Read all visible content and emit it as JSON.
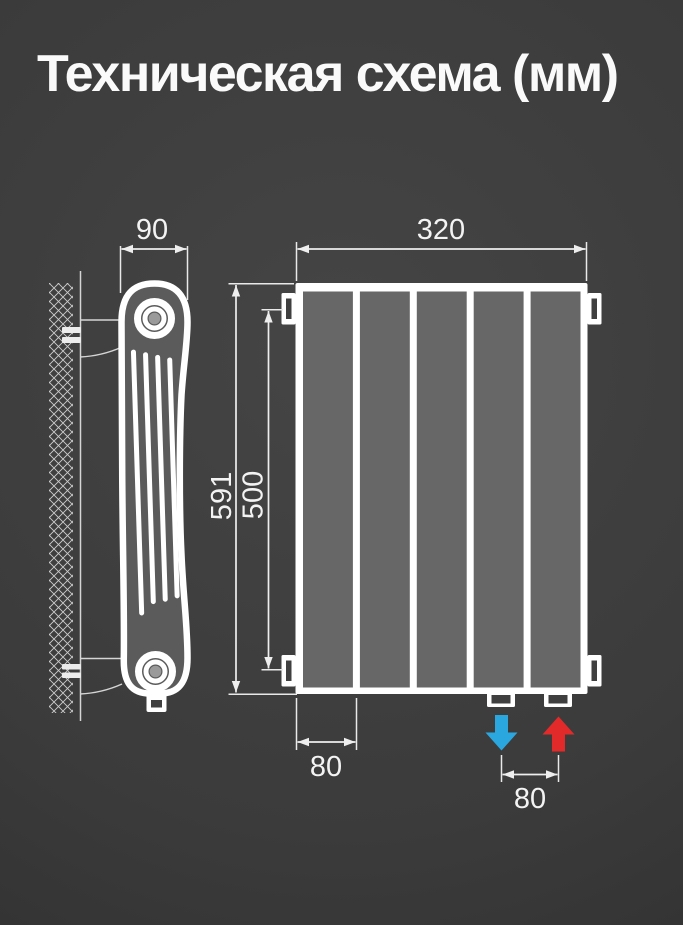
{
  "title": "Техническая схема (мм)",
  "dimensions": {
    "depth": "90",
    "width": "320",
    "height": "591",
    "axle_distance": "500",
    "section_width": "80",
    "connection_pitch": "80"
  },
  "front_view": {
    "sections_count": 5
  },
  "colors": {
    "background": "#3b3b3b",
    "outline_white": "#ffffff",
    "radiator_side_fill": "#5b5b5b",
    "panel_fill": "#676767",
    "dimension_line": "#eeeeee",
    "inlet_blue": "#2ba7df",
    "outlet_red": "#e32a2a"
  },
  "icons": {
    "inlet": "arrow-down-icon",
    "outlet": "arrow-up-icon"
  }
}
